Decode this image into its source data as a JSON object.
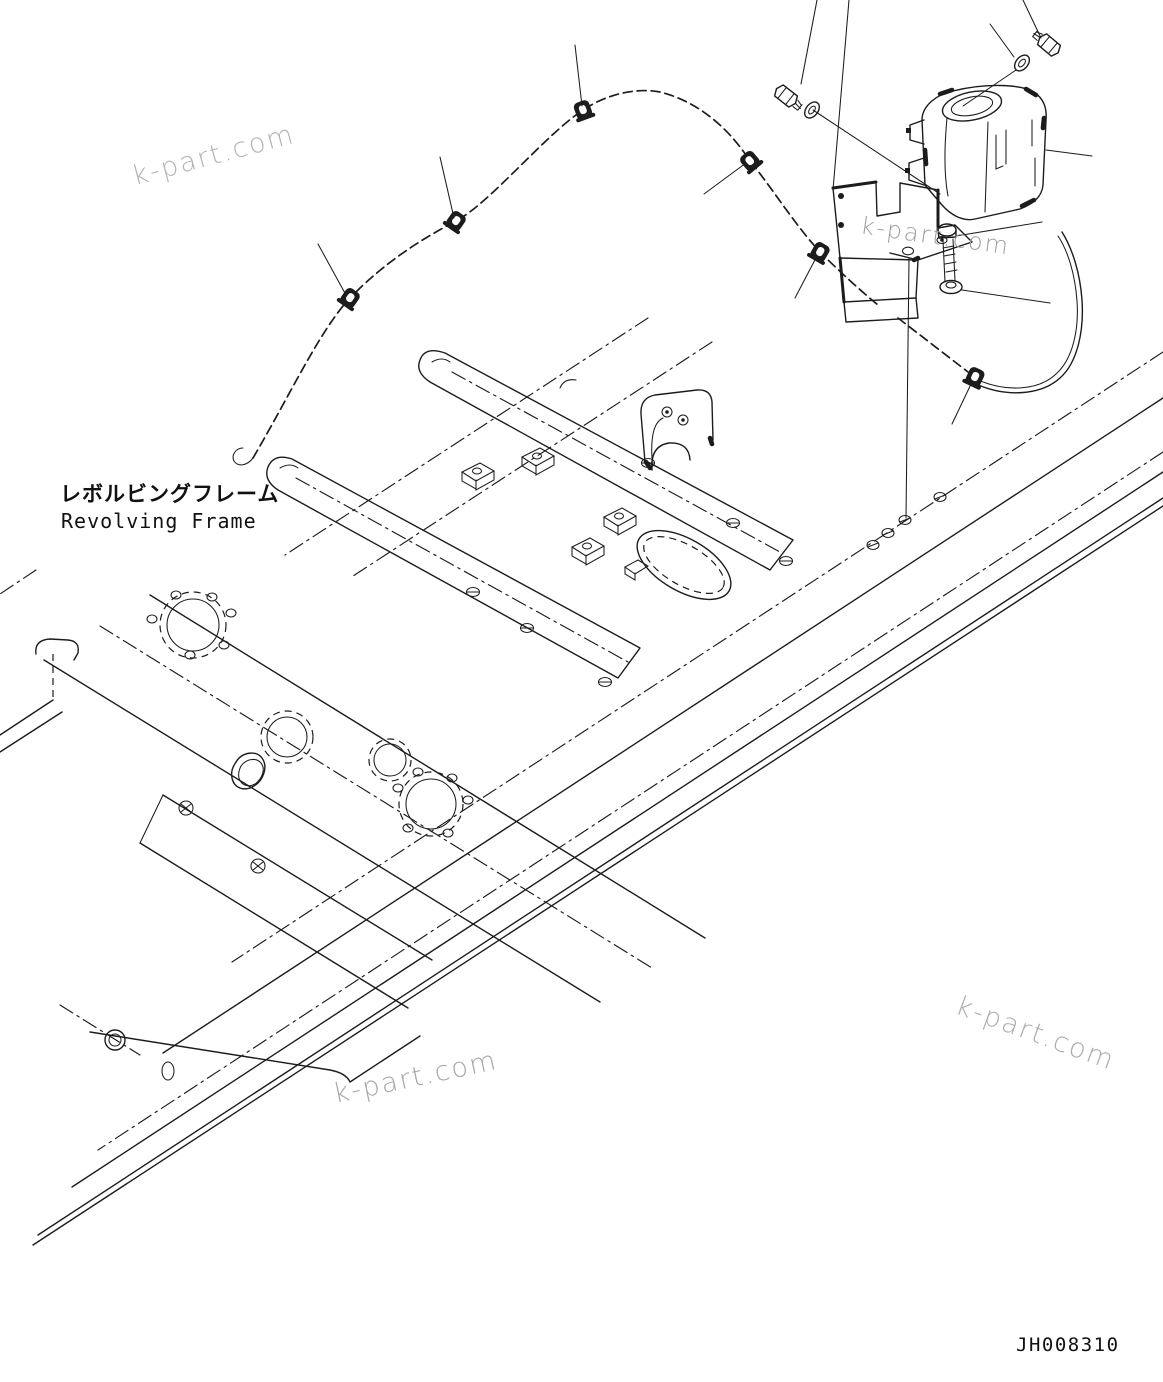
{
  "document": {
    "frame_label_ja": "レボルビングフレーム",
    "frame_label_en": "Revolving Frame",
    "doc_number": "JH008310",
    "watermark_text": "k-part.com",
    "colors": {
      "ink": "#1c1c1c",
      "background": "#ffffff",
      "watermark": "#b3b3b3"
    }
  },
  "diagram": {
    "type": "parts-exploded-line-drawing",
    "components": [
      "revolving-frame",
      "washer-tank",
      "tank-mounting-bracket",
      "mounting-bolt-left",
      "washer-left",
      "mounting-bolt-top-right",
      "washer-top-right",
      "tank-bolt",
      "tank-bolt-washer",
      "washer-hose",
      "hose-clip-1",
      "hose-clip-2",
      "hose-clip-3",
      "hose-clip-4",
      "hose-clip-5",
      "hose-clip-6"
    ]
  }
}
